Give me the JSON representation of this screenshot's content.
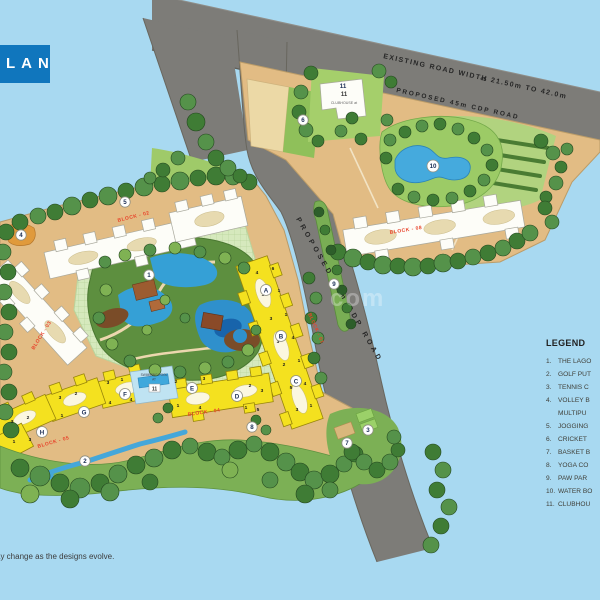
{
  "title": {
    "visible_text": "LAN"
  },
  "roads": {
    "existing_label": "EXISTING ROAD WIDTH 21.50m TO 42.0m",
    "width_mark": "45",
    "proposed_label_top": "PROPOSED 45m CDP ROAD",
    "proposed_label_diagonal": "PROPOSED 45m CDP ROAD"
  },
  "block_labels": {
    "b01": "BLOCK - 01",
    "b02": "BLOCK - 02",
    "b03": "BLOCK - 03",
    "b04": "BLOCK - 04",
    "b05": "BLOCK - 05",
    "b08": "BLOCK - 08"
  },
  "clubhouse": {
    "num": "11",
    "label": "CLUBHOUSE at"
  },
  "pool_parcel": {
    "line1": "SWIMMING POOL",
    "line2": "AT",
    "num": "11"
  },
  "markers": {
    "m1": "1",
    "m2": "2",
    "m3": "3",
    "m4": "4",
    "m5": "5",
    "m6": "6",
    "m7": "7",
    "m8": "8",
    "m9": "9",
    "m10": "10",
    "m11": "11",
    "mA": "A",
    "mB": "B",
    "mC": "C",
    "mD": "D",
    "mE": "E",
    "mF": "F",
    "mG": "G",
    "mH": "H"
  },
  "units": [
    "1",
    "2",
    "3",
    "4",
    "5",
    "6"
  ],
  "legend": {
    "title": "LEGEND",
    "rows": [
      {
        "n": "1.",
        "t": "THE LAGO"
      },
      {
        "n": "2.",
        "t": "GOLF PUT"
      },
      {
        "n": "3.",
        "t": "TENNIS C"
      },
      {
        "n": "4.",
        "t": "VOLLEY B"
      },
      {
        "n": "",
        "t": "MULTIPU"
      },
      {
        "n": "5.",
        "t": "JOGGING"
      },
      {
        "n": "6.",
        "t": "CRICKET"
      },
      {
        "n": "7.",
        "t": "BASKET B"
      },
      {
        "n": "8.",
        "t": "YOGA CO"
      },
      {
        "n": "9.",
        "t": "PAW PAR"
      },
      {
        "n": "10.",
        "t": "WATER BO"
      },
      {
        "n": "11.",
        "t": "CLUBHOU"
      }
    ]
  },
  "note": "ay change as the designs evolve.",
  "watermark": "com",
  "colors": {
    "sky": "#a8d9f1",
    "road": "#7d7c78",
    "tan": "#e2bc84",
    "accent_blue": "#1076bd",
    "water": "#37a0d8",
    "block_red": "#e8432b",
    "building_yellow": "#f4e11f"
  }
}
